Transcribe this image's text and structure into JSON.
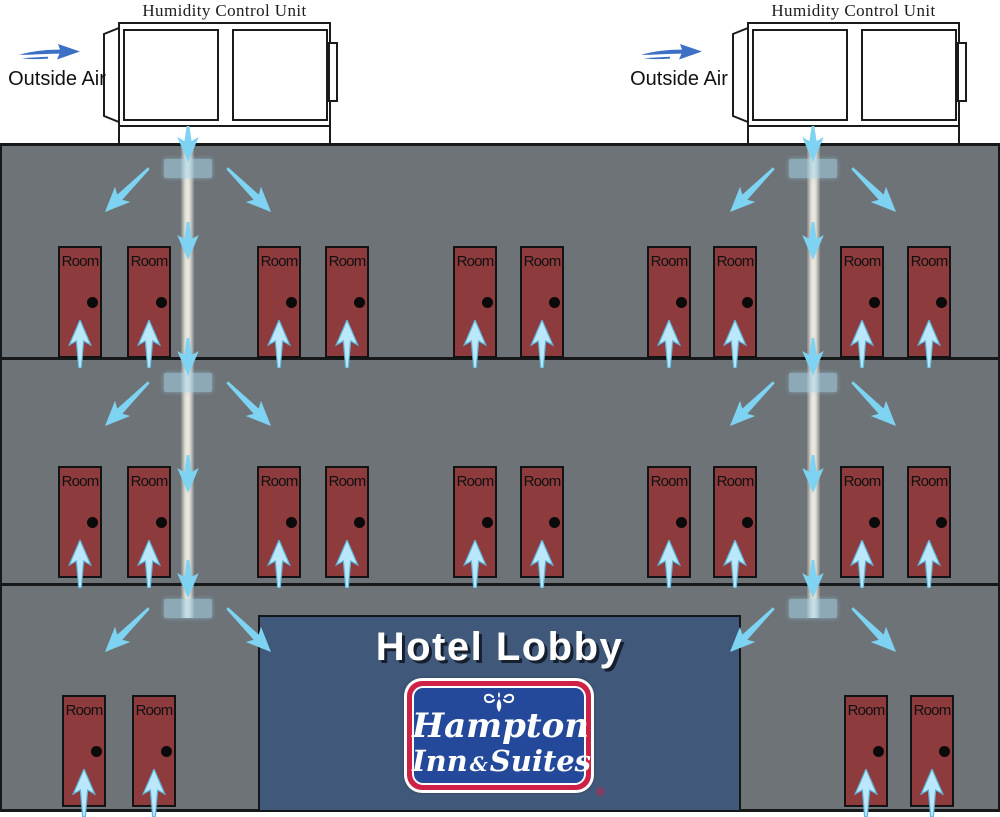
{
  "units": {
    "label": "Humidity Control Unit",
    "outside_air_label": "Outside Air"
  },
  "building": {
    "door_label": "Room",
    "floors": [
      {
        "id": "floor-1",
        "doors": 10
      },
      {
        "id": "floor-2",
        "doors": 10
      },
      {
        "id": "floor-3",
        "doors": 4
      }
    ],
    "duct_count": 2,
    "diffusers_per_duct": 3
  },
  "lobby": {
    "title": "Hotel Lobby"
  },
  "logo": {
    "word1": "Hampton",
    "word2": "Inn",
    "ampersand": "&",
    "word3": "Suites",
    "registered": "®"
  },
  "icons": {
    "airflow_arrow": "tapered light-blue chevron arrow",
    "outside_air_arrow": "blue swoosh arrow pointing right",
    "diffuser": "translucent light-blue ceiling vent rectangle",
    "ornament": "white scroll fleur ornament"
  },
  "colors": {
    "building_wall": "#6d7377",
    "floor_line": "#17181a",
    "door_red": "#8e3b3e",
    "lobby_blue": "#40587a",
    "flow_arrow_blue": "#7fd3f2",
    "door_arrow_blue": "#bae7fa",
    "door_arrow_edge": "#5fb7da",
    "outside_air_arrow_blue": "#3b70c4",
    "duct_tan": "#e9e5d9",
    "diffuser_blue": "#a5d5ea",
    "logo_red": "#cf2045",
    "logo_blue": "#24489a"
  }
}
